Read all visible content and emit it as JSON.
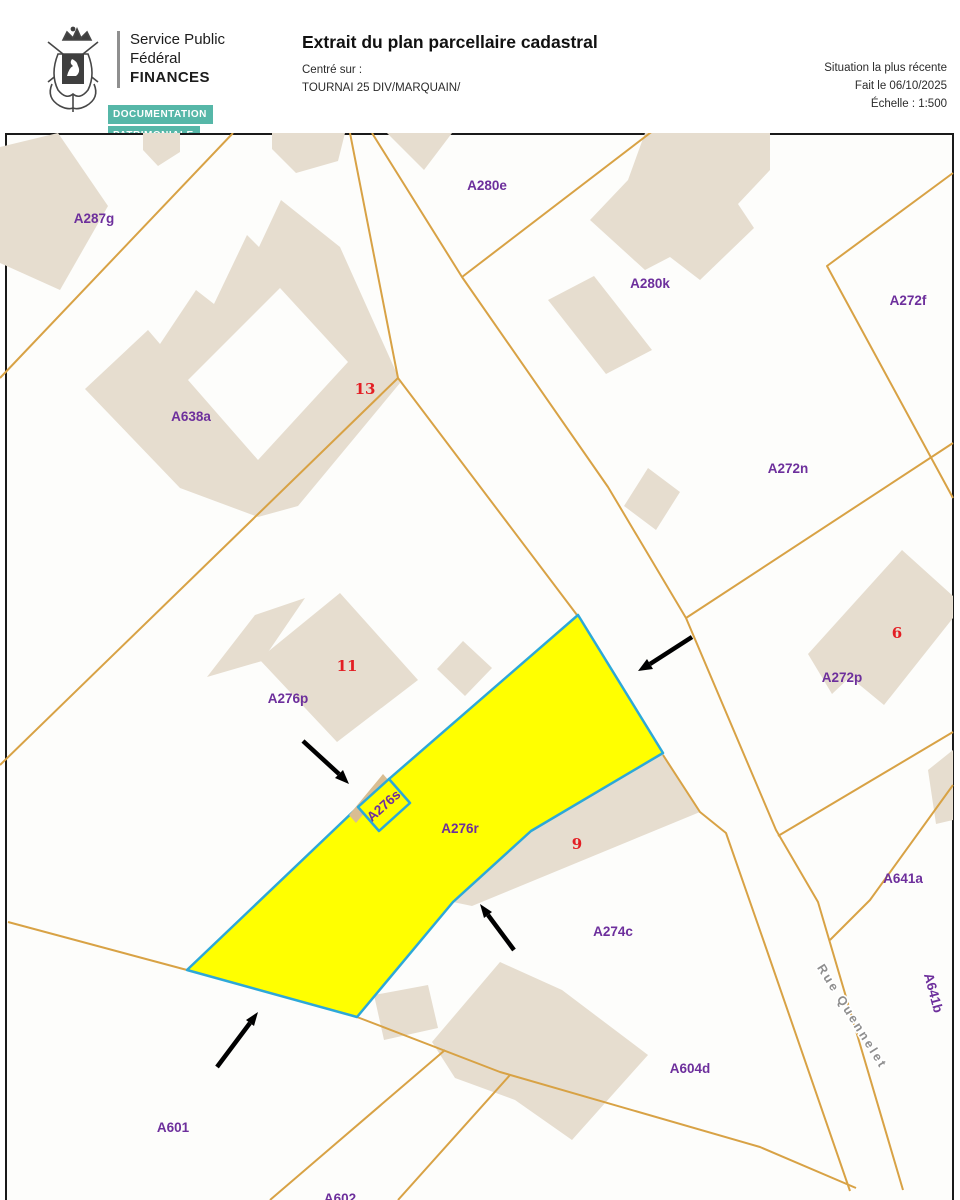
{
  "header": {
    "org_line1": "Service Public",
    "org_line2": "Fédéral",
    "org_line3": "FINANCES",
    "badge1": "DOCUMENTATION",
    "badge2": "PATRIMONIALE",
    "title": "Extrait du plan parcellaire cadastral",
    "centered_on_label": "Centré sur :",
    "centered_on_value": "TOURNAI 25 DIV/MARQUAIN/",
    "situation": "Situation la plus récente",
    "date": "Fait le 06/10/2025",
    "scale": "Échelle : 1:500"
  },
  "map": {
    "highlighted_parcel": "A276r",
    "parcels": [
      {
        "label": "A287g"
      },
      {
        "label": "A638a"
      },
      {
        "label": "A280e"
      },
      {
        "label": "A280k"
      },
      {
        "label": "A272f"
      },
      {
        "label": "A272n"
      },
      {
        "label": "A272p"
      },
      {
        "label": "A276p"
      },
      {
        "label": "A276r"
      },
      {
        "label": "A276s"
      },
      {
        "label": "A274c"
      },
      {
        "label": "A641a"
      },
      {
        "label": "A641b"
      },
      {
        "label": "A604d"
      },
      {
        "label": "A601"
      },
      {
        "label": "A602"
      }
    ],
    "house_numbers": [
      {
        "label": "13"
      },
      {
        "label": "11"
      },
      {
        "label": "9"
      },
      {
        "label": "6"
      }
    ],
    "street": {
      "name": "Rue Quennelet"
    },
    "colors": {
      "parcel_line": "#d8a245",
      "building_fill": "#e6ddcf",
      "highlight_fill": "#ffff00",
      "highlight_stroke": "#2da8d8",
      "parcel_label": "#6d2f9c",
      "house_number": "#e31e24",
      "street_label": "#8e8e8e",
      "badge_teal": "#56b7a8"
    }
  }
}
